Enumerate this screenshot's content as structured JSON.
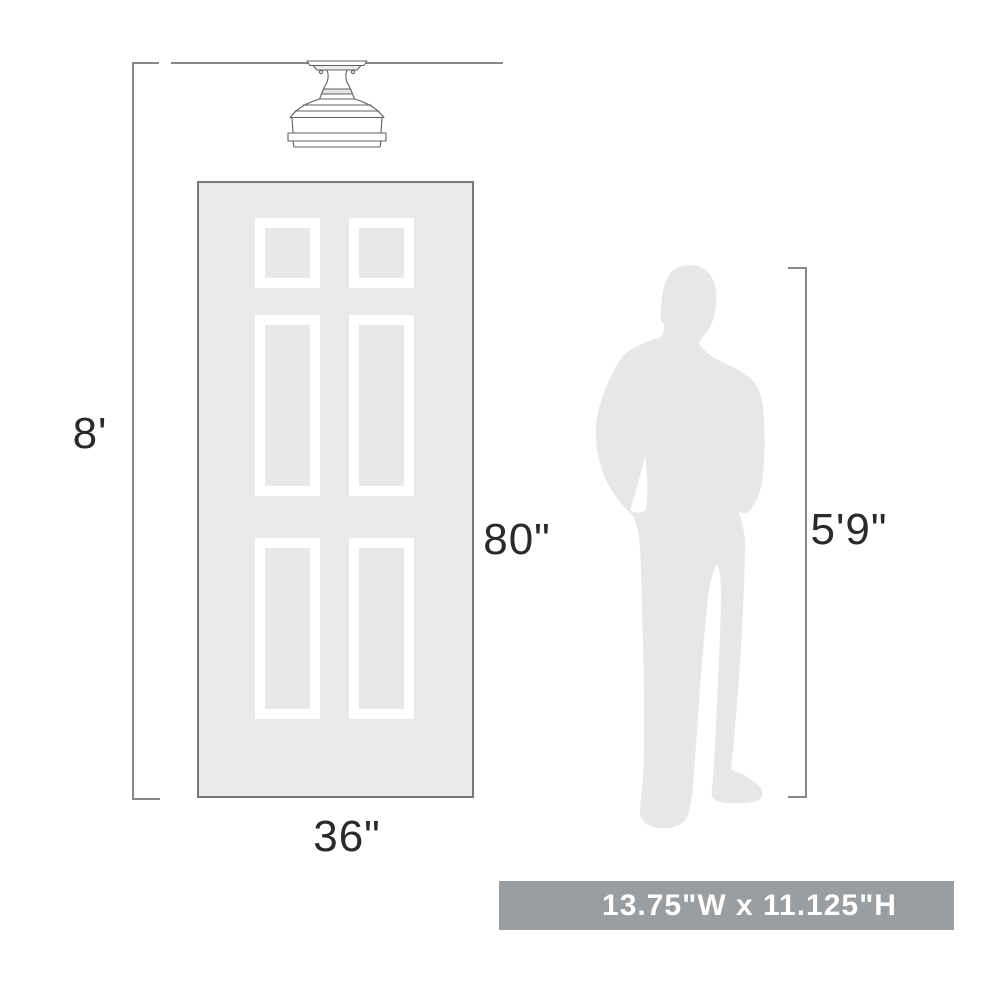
{
  "diagram": {
    "title_hint": "ceiling light fixture size diagram",
    "labels": {
      "ceiling_height": "8'",
      "door_height": "80\"",
      "door_width": "36\"",
      "person_height": "5'9\""
    },
    "banner": {
      "text": "13.75\"W x 11.125\"H"
    },
    "icons": {
      "fixture": "semi-flush-ceiling-light",
      "door": "six-panel-door",
      "person": "standing-man-silhouette"
    },
    "colors": {
      "door_fill": "#e8e9ea",
      "panel_inner_fill": "#e7e8e9",
      "panel_frame": "#ffffff",
      "silhouette_gray": "#e6e7e9",
      "dimension_line_gray": "#87898c",
      "banner_gray": "#9b9ea1",
      "banner_text": "#ffffff",
      "label_text": "#2a2a2c",
      "fixture_outline": "#606165"
    }
  }
}
